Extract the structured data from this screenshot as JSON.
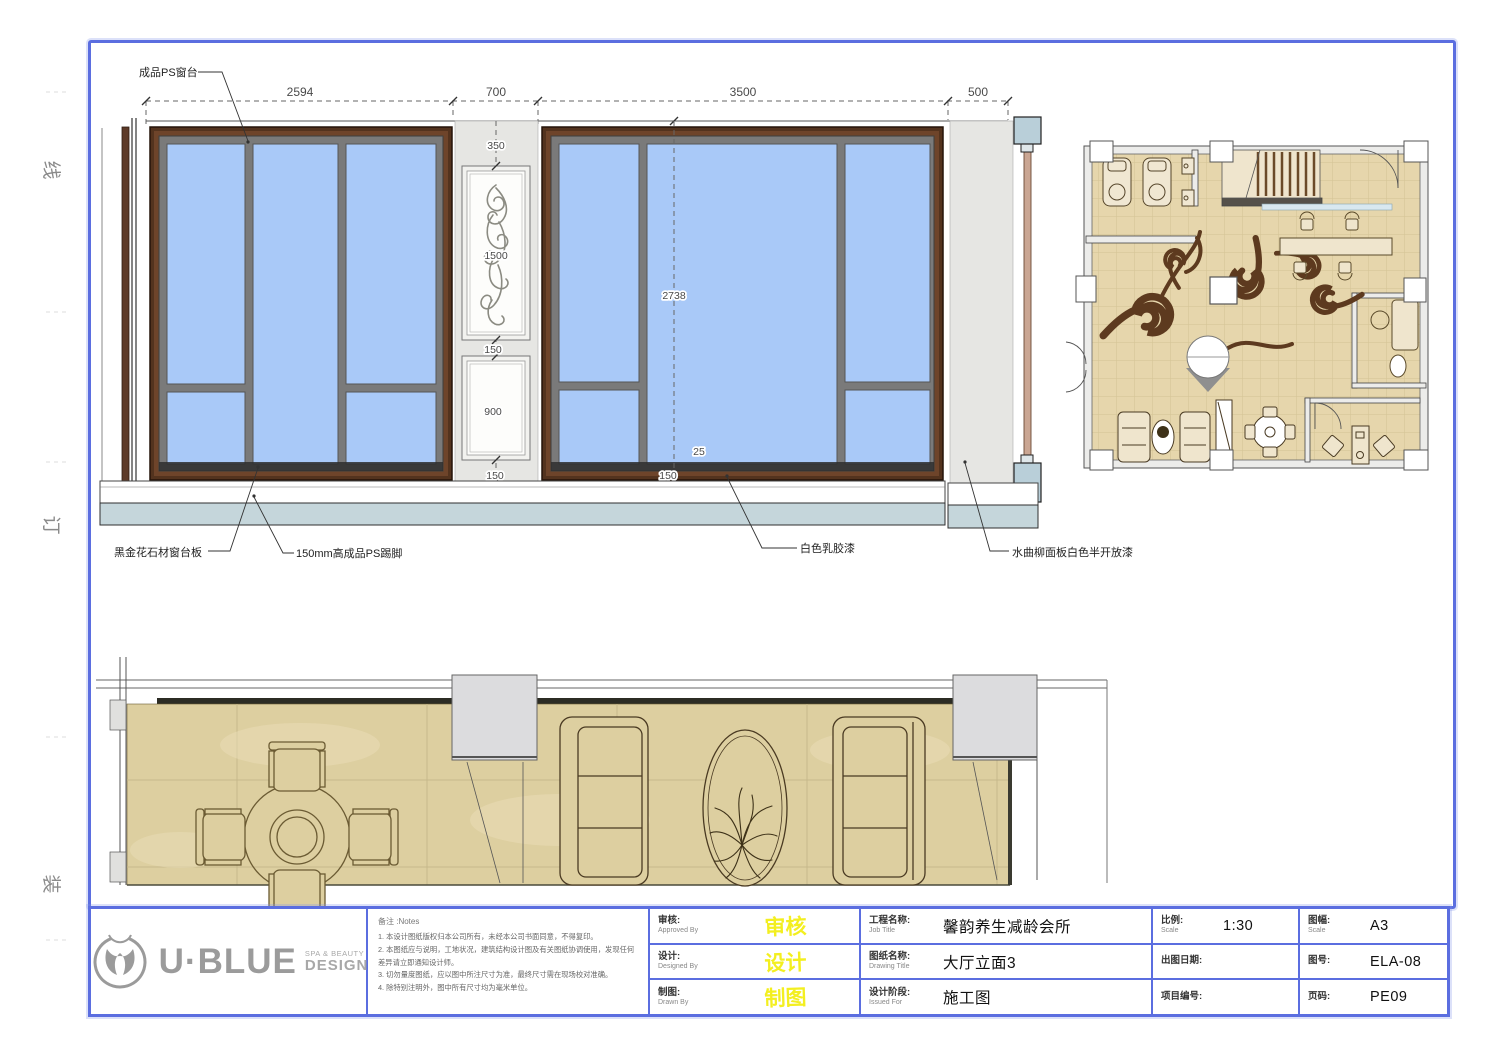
{
  "margin": {
    "marks": [
      "线",
      "订",
      "装"
    ]
  },
  "elevation": {
    "top_dims": [
      "2594",
      "700",
      "3500",
      "500"
    ],
    "offset_dim": "138",
    "height_dim": "2738",
    "d350": "350",
    "d1500": "1500",
    "d150a": "150",
    "d900": "900",
    "d150b": "150",
    "d150c": "150",
    "d25": "25",
    "d150d": "150",
    "d150e": "150",
    "callouts": {
      "ps_sill": "成品PS窗台",
      "stone_sill": "黑金花石材窗台板",
      "skirting": "150mm高成品PS踢脚",
      "paint": "白色乳胶漆",
      "ash_panel": "水曲柳面板白色半开放漆"
    }
  },
  "titleblock": {
    "logo": {
      "brand": "U·BLUE",
      "sub1": "SPA & BEAUTY",
      "sub2": "DESIGN"
    },
    "notes": {
      "heading": "备注 :Notes",
      "items": [
        "1. 本设计图纸版权归本公司所有，未经本公司书面同意，不得复印。",
        "2. 本图纸应与说明，工地状况，建筑结构设计图及有关图纸协调使用，发现任何差异请立即通知设计师。",
        "3. 切勿量度图纸，应以图中所注尺寸为准，最终尺寸需在现场校对准确。",
        "4. 除特别注明外，图中所有尺寸均为毫米单位。"
      ]
    },
    "sign_rows": [
      {
        "label_cn": "审核:",
        "label_en": "Approved By",
        "value": "审核"
      },
      {
        "label_cn": "设计:",
        "label_en": "Designed By",
        "value": "设计"
      },
      {
        "label_cn": "制图:",
        "label_en": "Drawn By",
        "value": "制图"
      }
    ],
    "job_rows": [
      {
        "label_cn": "工程名称:",
        "label_en": "Job Title",
        "value": "馨韵养生减龄会所"
      },
      {
        "label_cn": "图纸名称:",
        "label_en": "Drawing Title",
        "value": "大厅立面3"
      },
      {
        "label_cn": "设计阶段:",
        "label_en": "Issued For",
        "value": "施工图"
      }
    ],
    "meta_rows": [
      {
        "label_cn": "比例:",
        "label_en": "Scale",
        "value": "1:30"
      },
      {
        "label_cn": "出图日期:",
        "label_en": "",
        "value": ""
      },
      {
        "label_cn": "项目编号:",
        "label_en": "",
        "value": ""
      }
    ],
    "sheet_rows": [
      {
        "label_cn": "图幅:",
        "label_en": "Scale",
        "value": "A3"
      },
      {
        "label_cn": "图号:",
        "label_en": "",
        "value": "ELA-08"
      },
      {
        "label_cn": "页码:",
        "label_en": "",
        "value": "PE09"
      }
    ]
  },
  "colors": {
    "frame_blue": "#5b6ee0",
    "glass_blue": "#a9c9f8",
    "wood_brown": "#5d3a25",
    "skirting_blue": "#c5d6db",
    "floor_beige": "#e6d6ac",
    "swirl_brown": "#5d3a1f",
    "signature_yellow": "#f3ef20"
  }
}
